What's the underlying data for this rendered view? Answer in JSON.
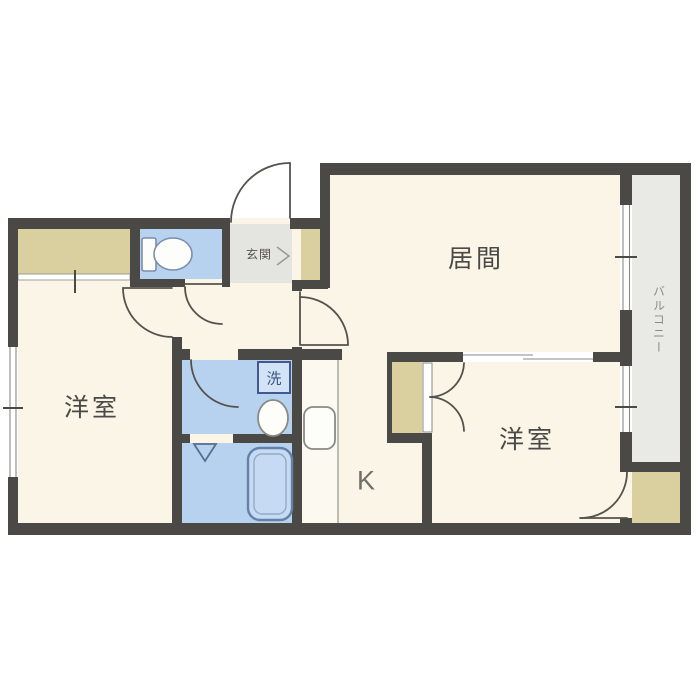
{
  "plan": {
    "labels": {
      "living": "居間",
      "bedroom_left": "洋室",
      "bedroom_right": "洋室",
      "entrance": "玄関",
      "kitchen": "K",
      "balcony": "バルコニー",
      "laundry": "洗"
    },
    "colors": {
      "wall": "#4a4945",
      "floor": "#faf5e6",
      "wet_area": "#b7d2ee",
      "closet": "#d9cf9f",
      "balcony": "#e9e9e6",
      "entrance_tile": "#e4e4e1",
      "door_line": "#55524e",
      "fixture_blue": "#c6daf3",
      "label_text": "#4a4945"
    },
    "icons": [
      "toilet-icon",
      "washbasin-icon",
      "bathtub-icon",
      "washing-machine-icon",
      "kitchen-sink-icon",
      "shower-fold-door-icon",
      "shoe-cabinet-chevron-icon",
      "door-swing-icon",
      "window-icon",
      "sliding-door-icon"
    ]
  }
}
